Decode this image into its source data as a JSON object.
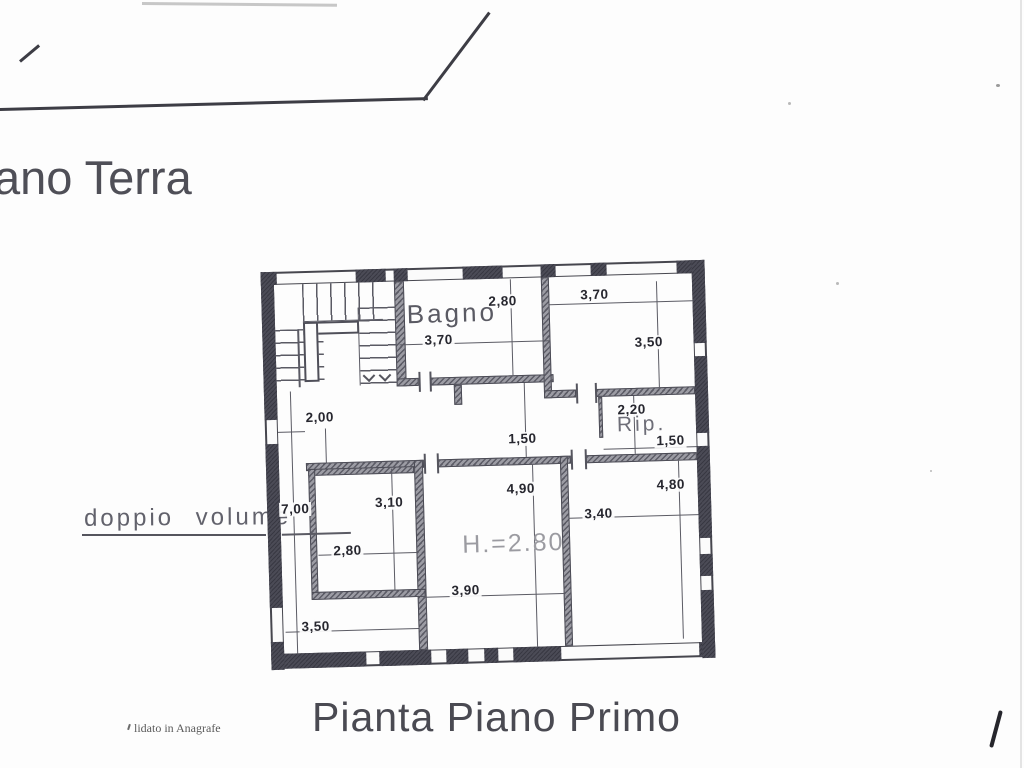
{
  "header": {
    "fragment": "ano Terra"
  },
  "plan": {
    "rooms": {
      "bagno": "Bagno",
      "rip": "Rip."
    },
    "notes": {
      "doppio": "doppio volume",
      "height": "H.=2.80"
    },
    "dims": {
      "bagno_w": "3,70",
      "bagno_d": "2,80",
      "tr_w": "3,70",
      "tr_d": "3,50",
      "left_corr": "2,00",
      "corr": "1,50",
      "rip_w": "2,20",
      "rip_d": "1,50",
      "left_h": "7,00",
      "small_d": "3,10",
      "small_w": "2,80",
      "left_w": "3,50",
      "center_d": "4,90",
      "center_w": "3,90",
      "right_w": "3,40",
      "right_d": "4,80"
    }
  },
  "footer": {
    "title": "Pianta Piano Primo",
    "stamp": "lidato in Anagrafe"
  },
  "colors": {
    "ink": "#3f3f48",
    "wall_dark": "#4b4b56",
    "wall_hatch": "#9c9ca4",
    "pencil": "#9b9ba1"
  }
}
